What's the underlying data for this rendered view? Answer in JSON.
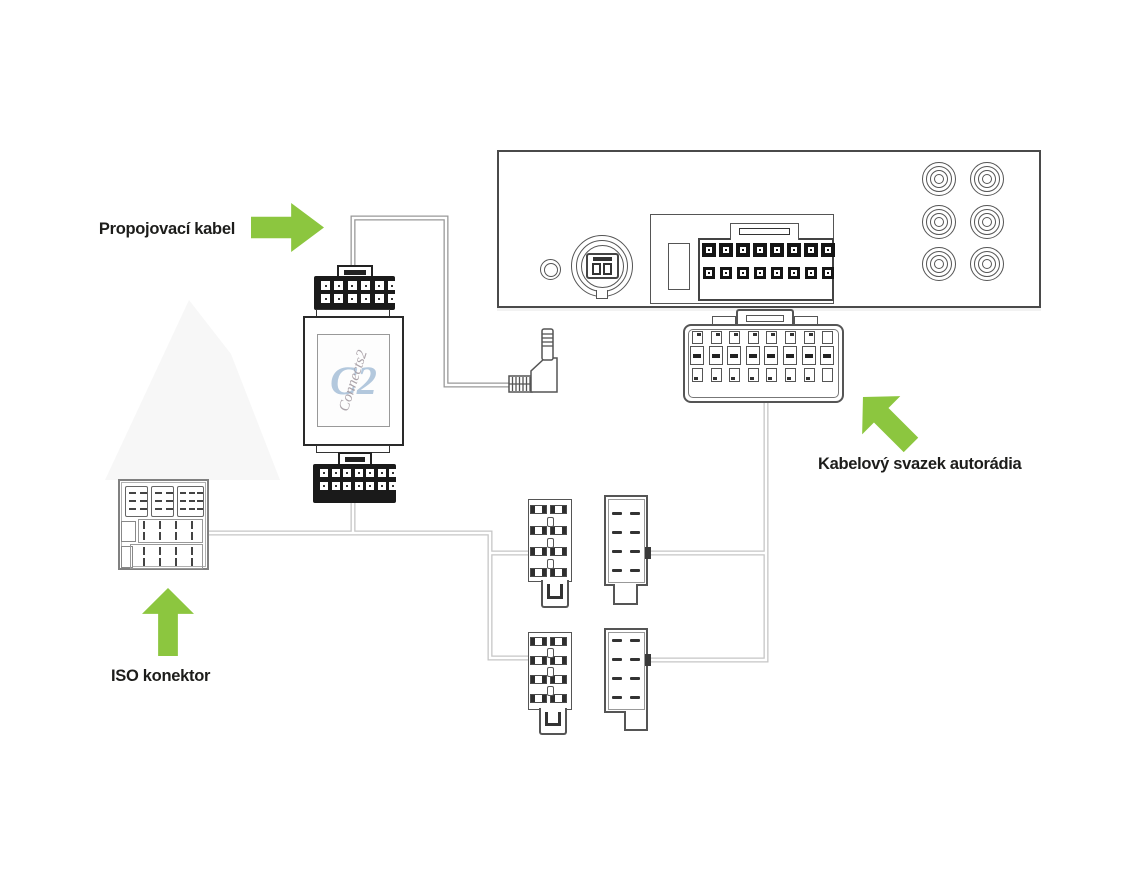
{
  "labels": {
    "connection_cable": "Propojovací kabel",
    "radio_harness": "Kabelový svazek autorádia",
    "iso_connector": "ISO konektor"
  },
  "adapter": {
    "logo_mark": "C2",
    "logo_script": "Connects2"
  },
  "colors": {
    "arrow_green": "#8cc63f",
    "label_text": "#1d1d1b",
    "cable_light": "#c6c6c6",
    "cable_dark": "#999999",
    "connector_black": "#1a1a1a",
    "outline_gray": "#555555",
    "logo_blue": "#b3c8dd",
    "logo_script_gray": "#a39aa1"
  }
}
